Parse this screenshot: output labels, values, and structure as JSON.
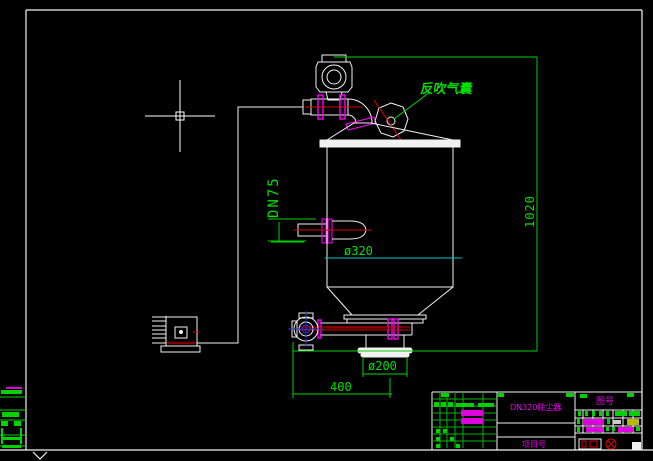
{
  "app": {
    "type": "cad-viewport",
    "background": "#000000",
    "cursor": "crosshair"
  },
  "drawing": {
    "labels": {
      "air_bag": "反吹气囊"
    },
    "dimensions": {
      "inlet": "DN75",
      "shell_diameter": "ø320",
      "outlet_diameter": "ø200",
      "width": "400",
      "height": "1020"
    },
    "colors": {
      "dimension_green": "#00d200",
      "annotation_magenta": "#ff00ff",
      "centerline_red": "#e00000",
      "dark_red": "#7a0000",
      "cyan": "#00c8c8",
      "entity_white": "#f2f2f2",
      "valve_blue": "#2233cc",
      "title_yellow": "#b8b800"
    }
  },
  "title_block": {
    "title": "DN320除尘器",
    "right_header": "图号",
    "project_label": "项目号",
    "marks": [
      {
        "x": 441,
        "y": 393,
        "w": 8,
        "h": 4,
        "c": "#00d200"
      },
      {
        "x": 497,
        "y": 393,
        "w": 7,
        "h": 4,
        "c": "#00d200"
      },
      {
        "x": 566,
        "y": 393,
        "w": 8,
        "h": 4,
        "c": "#00d200"
      },
      {
        "x": 627,
        "y": 393,
        "w": 7,
        "h": 4,
        "c": "#00d200"
      },
      {
        "x": 434,
        "y": 402,
        "w": 5,
        "h": 5,
        "c": "#00d200"
      },
      {
        "x": 441,
        "y": 402,
        "w": 5,
        "h": 5,
        "c": "#00d200"
      },
      {
        "x": 448,
        "y": 402,
        "w": 5,
        "h": 5,
        "c": "#00d200"
      },
      {
        "x": 456,
        "y": 403,
        "w": 18,
        "h": 4,
        "c": "#00d200"
      },
      {
        "x": 478,
        "y": 403,
        "w": 16,
        "h": 4,
        "c": "#00d200"
      },
      {
        "x": 461,
        "y": 410,
        "w": 22,
        "h": 6,
        "c": "#dd00dd"
      },
      {
        "x": 461,
        "y": 418,
        "w": 22,
        "h": 6,
        "c": "#dd00dd"
      },
      {
        "x": 436,
        "y": 429,
        "w": 4,
        "h": 4,
        "c": "#00d200"
      },
      {
        "x": 443,
        "y": 429,
        "w": 4,
        "h": 4,
        "c": "#00d200"
      },
      {
        "x": 436,
        "y": 437,
        "w": 4,
        "h": 4,
        "c": "#00d200"
      },
      {
        "x": 450,
        "y": 437,
        "w": 4,
        "h": 4,
        "c": "#00d200"
      },
      {
        "x": 436,
        "y": 444,
        "w": 4,
        "h": 4,
        "c": "#00d200"
      },
      {
        "x": 456,
        "y": 444,
        "w": 4,
        "h": 4,
        "c": "#00d200"
      },
      {
        "x": 580,
        "y": 394,
        "w": 7,
        "h": 4,
        "c": "#00d200"
      },
      {
        "x": 578,
        "y": 411,
        "w": 3,
        "h": 5,
        "c": "#00d200"
      },
      {
        "x": 585,
        "y": 411,
        "w": 3,
        "h": 5,
        "c": "#00d200"
      },
      {
        "x": 592,
        "y": 411,
        "w": 3,
        "h": 5,
        "c": "#00d200"
      },
      {
        "x": 599,
        "y": 411,
        "w": 3,
        "h": 5,
        "c": "#00d200"
      },
      {
        "x": 606,
        "y": 411,
        "w": 3,
        "h": 5,
        "c": "#00d200"
      },
      {
        "x": 615,
        "y": 411,
        "w": 12,
        "h": 5,
        "c": "#00d200"
      },
      {
        "x": 629,
        "y": 411,
        "w": 11,
        "h": 5,
        "c": "#00d200"
      },
      {
        "x": 577,
        "y": 419,
        "w": 3,
        "h": 5,
        "c": "#00d200"
      },
      {
        "x": 583,
        "y": 419,
        "w": 21,
        "h": 6,
        "c": "#dd00dd"
      },
      {
        "x": 607,
        "y": 419,
        "w": 3,
        "h": 5,
        "c": "#00d200"
      },
      {
        "x": 613,
        "y": 420,
        "w": 8,
        "h": 4,
        "c": "#cccccc"
      },
      {
        "x": 627,
        "y": 419,
        "w": 12,
        "h": 6,
        "c": "#b8b800"
      },
      {
        "x": 577,
        "y": 427,
        "w": 3,
        "h": 5,
        "c": "#00d200"
      },
      {
        "x": 586,
        "y": 427,
        "w": 17,
        "h": 5,
        "c": "#dd00dd"
      },
      {
        "x": 606,
        "y": 427,
        "w": 3,
        "h": 4,
        "c": "#00d200"
      },
      {
        "x": 612,
        "y": 427,
        "w": 3,
        "h": 4,
        "c": "#00d200"
      },
      {
        "x": 618,
        "y": 427,
        "w": 15,
        "h": 5,
        "c": "#dd00dd"
      },
      {
        "x": 636,
        "y": 427,
        "w": 4,
        "h": 4,
        "c": "#00d200"
      }
    ]
  },
  "frame_marks": [
    {
      "x": 6,
      "y": 387,
      "w": 16,
      "h": 2,
      "c": "#dd00dd"
    },
    {
      "x": 1,
      "y": 390,
      "w": 21,
      "h": 4,
      "c": "#00d200"
    },
    {
      "x": 2,
      "y": 412,
      "w": 17,
      "h": 5,
      "c": "#00d200"
    },
    {
      "x": 1,
      "y": 421,
      "w": 7,
      "h": 5,
      "c": "#00d200"
    },
    {
      "x": 14,
      "y": 421,
      "w": 7,
      "h": 5,
      "c": "#00d200"
    },
    {
      "x": 1,
      "y": 428,
      "w": 2,
      "h": 16,
      "c": "#00d200"
    },
    {
      "x": 20,
      "y": 428,
      "w": 2,
      "h": 16,
      "c": "#00d200"
    },
    {
      "x": 2,
      "y": 437,
      "w": 19,
      "h": 3,
      "c": "#00d200"
    },
    {
      "x": 2,
      "y": 445,
      "w": 19,
      "h": 3,
      "c": "#00d200"
    }
  ]
}
